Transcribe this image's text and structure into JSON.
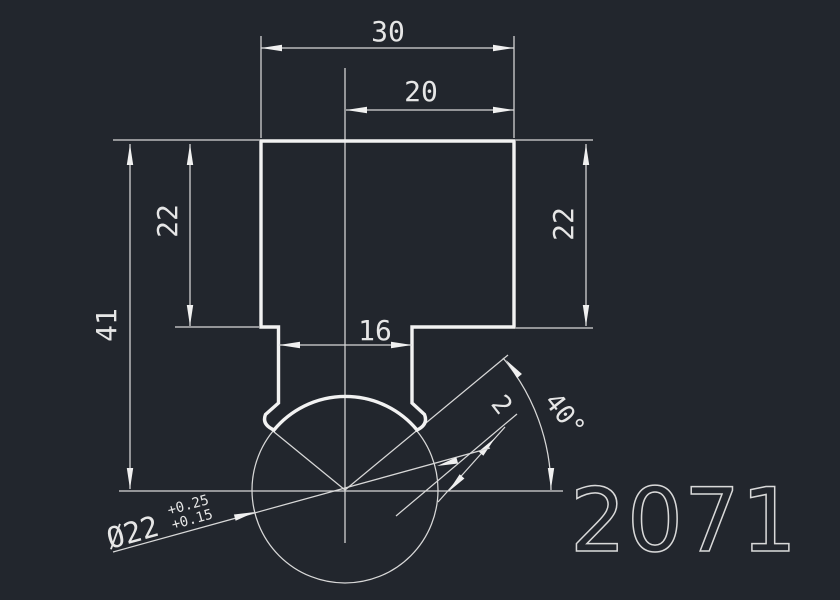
{
  "app": {
    "background_color": "#22262d",
    "line_color": "#e8e8e8"
  },
  "drawing": {
    "part_number": "2071",
    "dimensions": {
      "width_top": "30",
      "width_upper_right": "20",
      "height_outer_left": "41",
      "height_inner_left": "22",
      "height_right": "22",
      "neck_width": "16",
      "ball_angle": "40°",
      "chamfer": "2",
      "diameter": {
        "value": "Ø22",
        "tol_upper": "+0.25",
        "tol_lower": "+0.15"
      }
    }
  }
}
